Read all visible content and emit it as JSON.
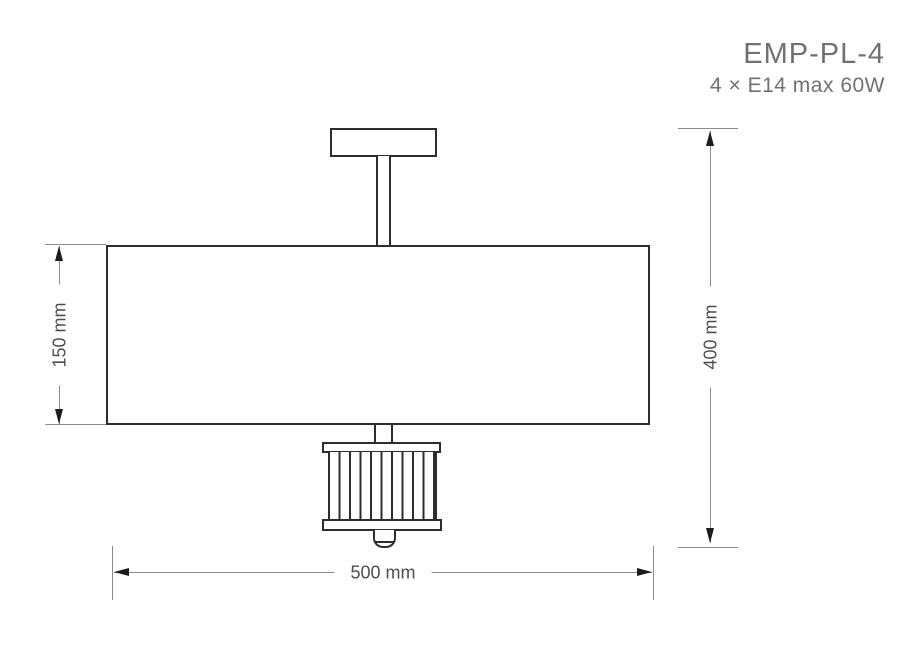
{
  "header": {
    "model": "EMP-PL-4",
    "spec": "4 × E14 max 60W"
  },
  "dimensions": {
    "shade_height": {
      "label": "150 mm",
      "value": 150,
      "unit": "mm"
    },
    "overall_height": {
      "label": "400 mm",
      "value": 400,
      "unit": "mm"
    },
    "width": {
      "label": "500 mm",
      "value": 500,
      "unit": "mm"
    }
  },
  "colors": {
    "fixture_line": "#2d2d2d",
    "dimension_line": "#8c8c8c",
    "arrowhead": "#1c1c1c",
    "dimension_text": "#4e4e50",
    "title_text": "#707173",
    "background": "#ffffff"
  }
}
